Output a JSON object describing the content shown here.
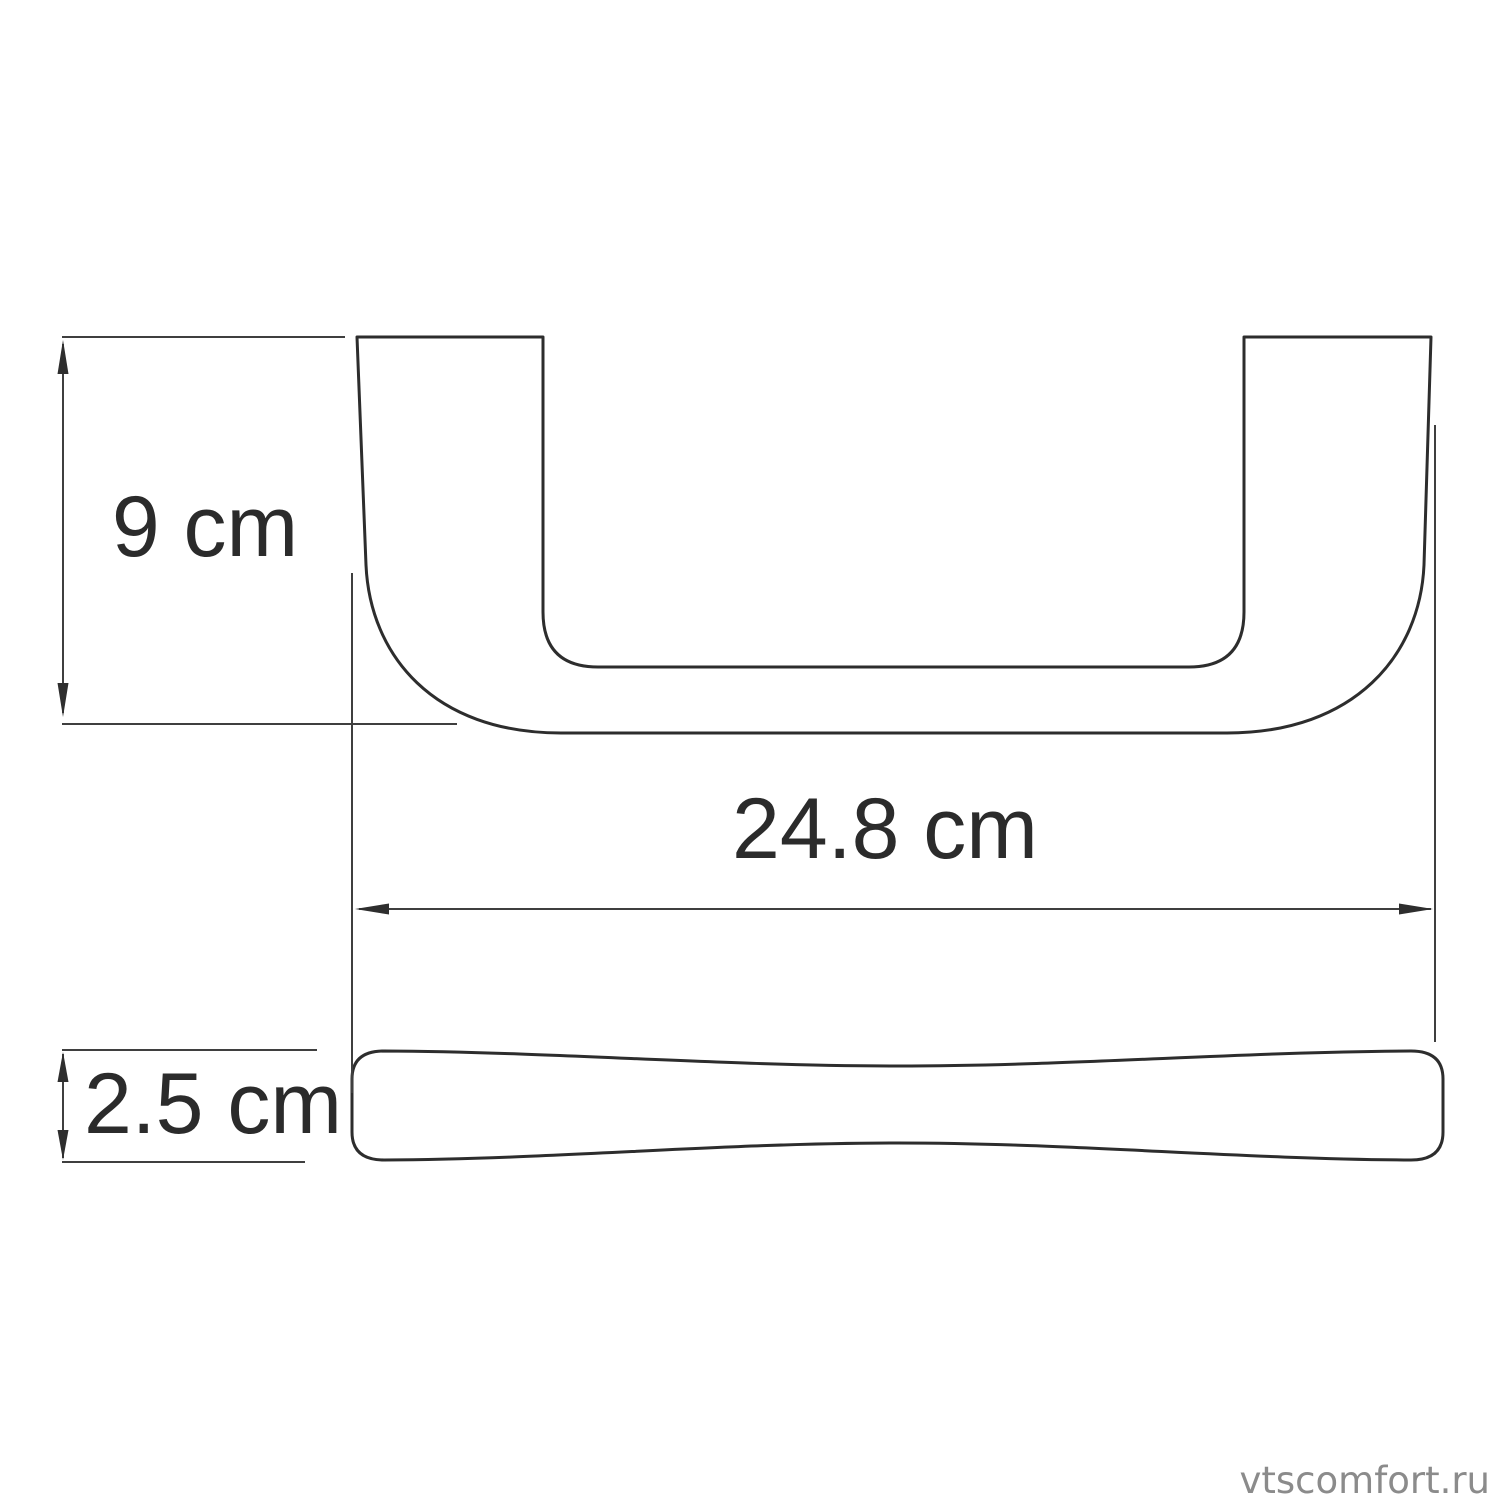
{
  "diagram": {
    "watermark": "vtscomfort.ru",
    "colors": {
      "background": "#ffffff",
      "outline": "#2d2d2d",
      "dimension_lines": "#3f3f3f",
      "text": "#2b2b2b",
      "watermark": "#8b8b8b"
    },
    "dimensions": {
      "height": {
        "label": "9 cm",
        "value": 9,
        "unit": "cm"
      },
      "width": {
        "label": "24.8 cm",
        "value": 24.8,
        "unit": "cm"
      },
      "depth": {
        "label": "2.5 cm",
        "value": 2.5,
        "unit": "cm"
      }
    }
  }
}
